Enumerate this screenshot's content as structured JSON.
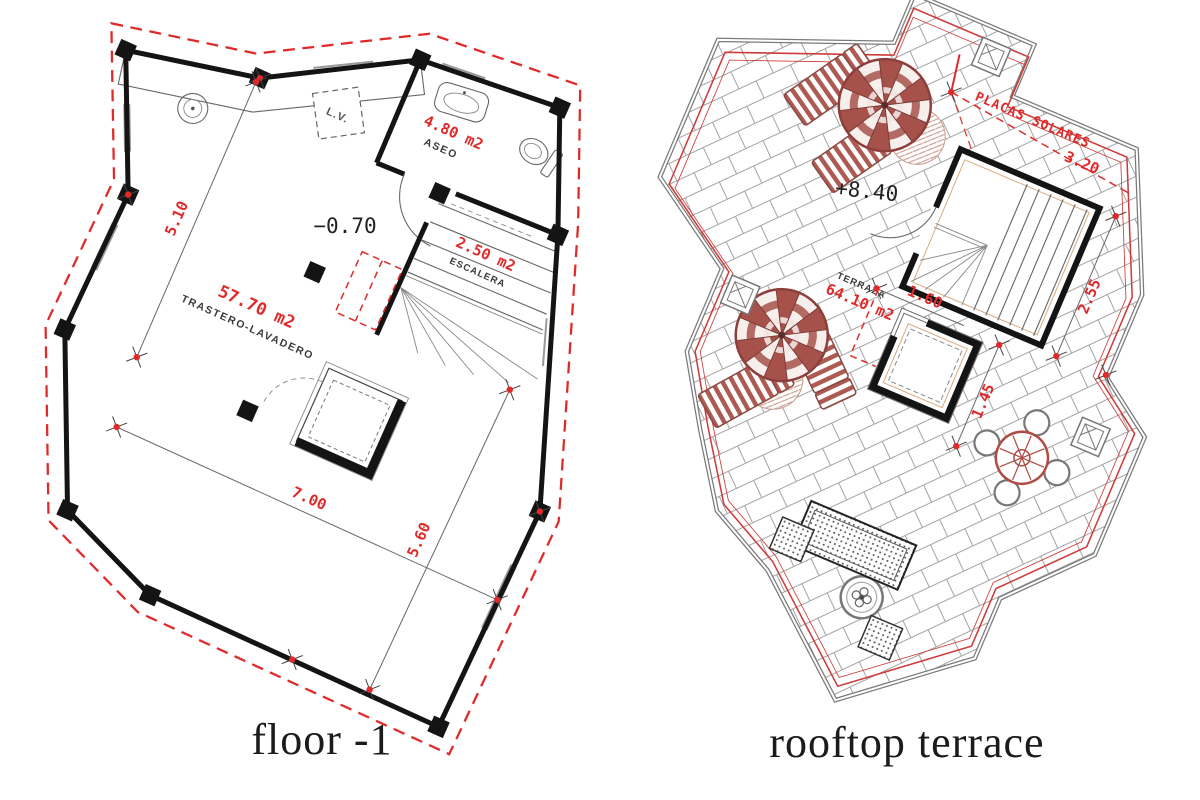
{
  "plan_left": {
    "caption": "floor -1",
    "level": "−0.70",
    "main_area": "57.70 m2",
    "main_name": "TRASTERO-LAVADERO",
    "bath_area": "4.80 m2",
    "bath_name": "ASEO",
    "stairs_area": "2.50 m2",
    "stairs_name": "ESCALERA",
    "appliance": "L.V.",
    "dim_left": "5.10",
    "dim_width": "7.00",
    "dim_depth": "5.60"
  },
  "plan_right": {
    "caption": "rooftop terrace",
    "level": "+8.40",
    "room_name": "TERRAZA",
    "room_area": "64.10 m2",
    "annotation": "PLACAS SOLARES",
    "dim_solar": "3.20",
    "dim_skylight_w": "1.60",
    "dim_stairwell": "2.55",
    "dim_skylight_h": "1.45"
  },
  "colors": {
    "annotation_red": "#e02a2a",
    "furniture_red": "#a6524b",
    "wall_ink": "#141414",
    "line_gray": "#8a8a8a",
    "caption_ink": "#1b1b1b",
    "background": "#ffffff"
  }
}
